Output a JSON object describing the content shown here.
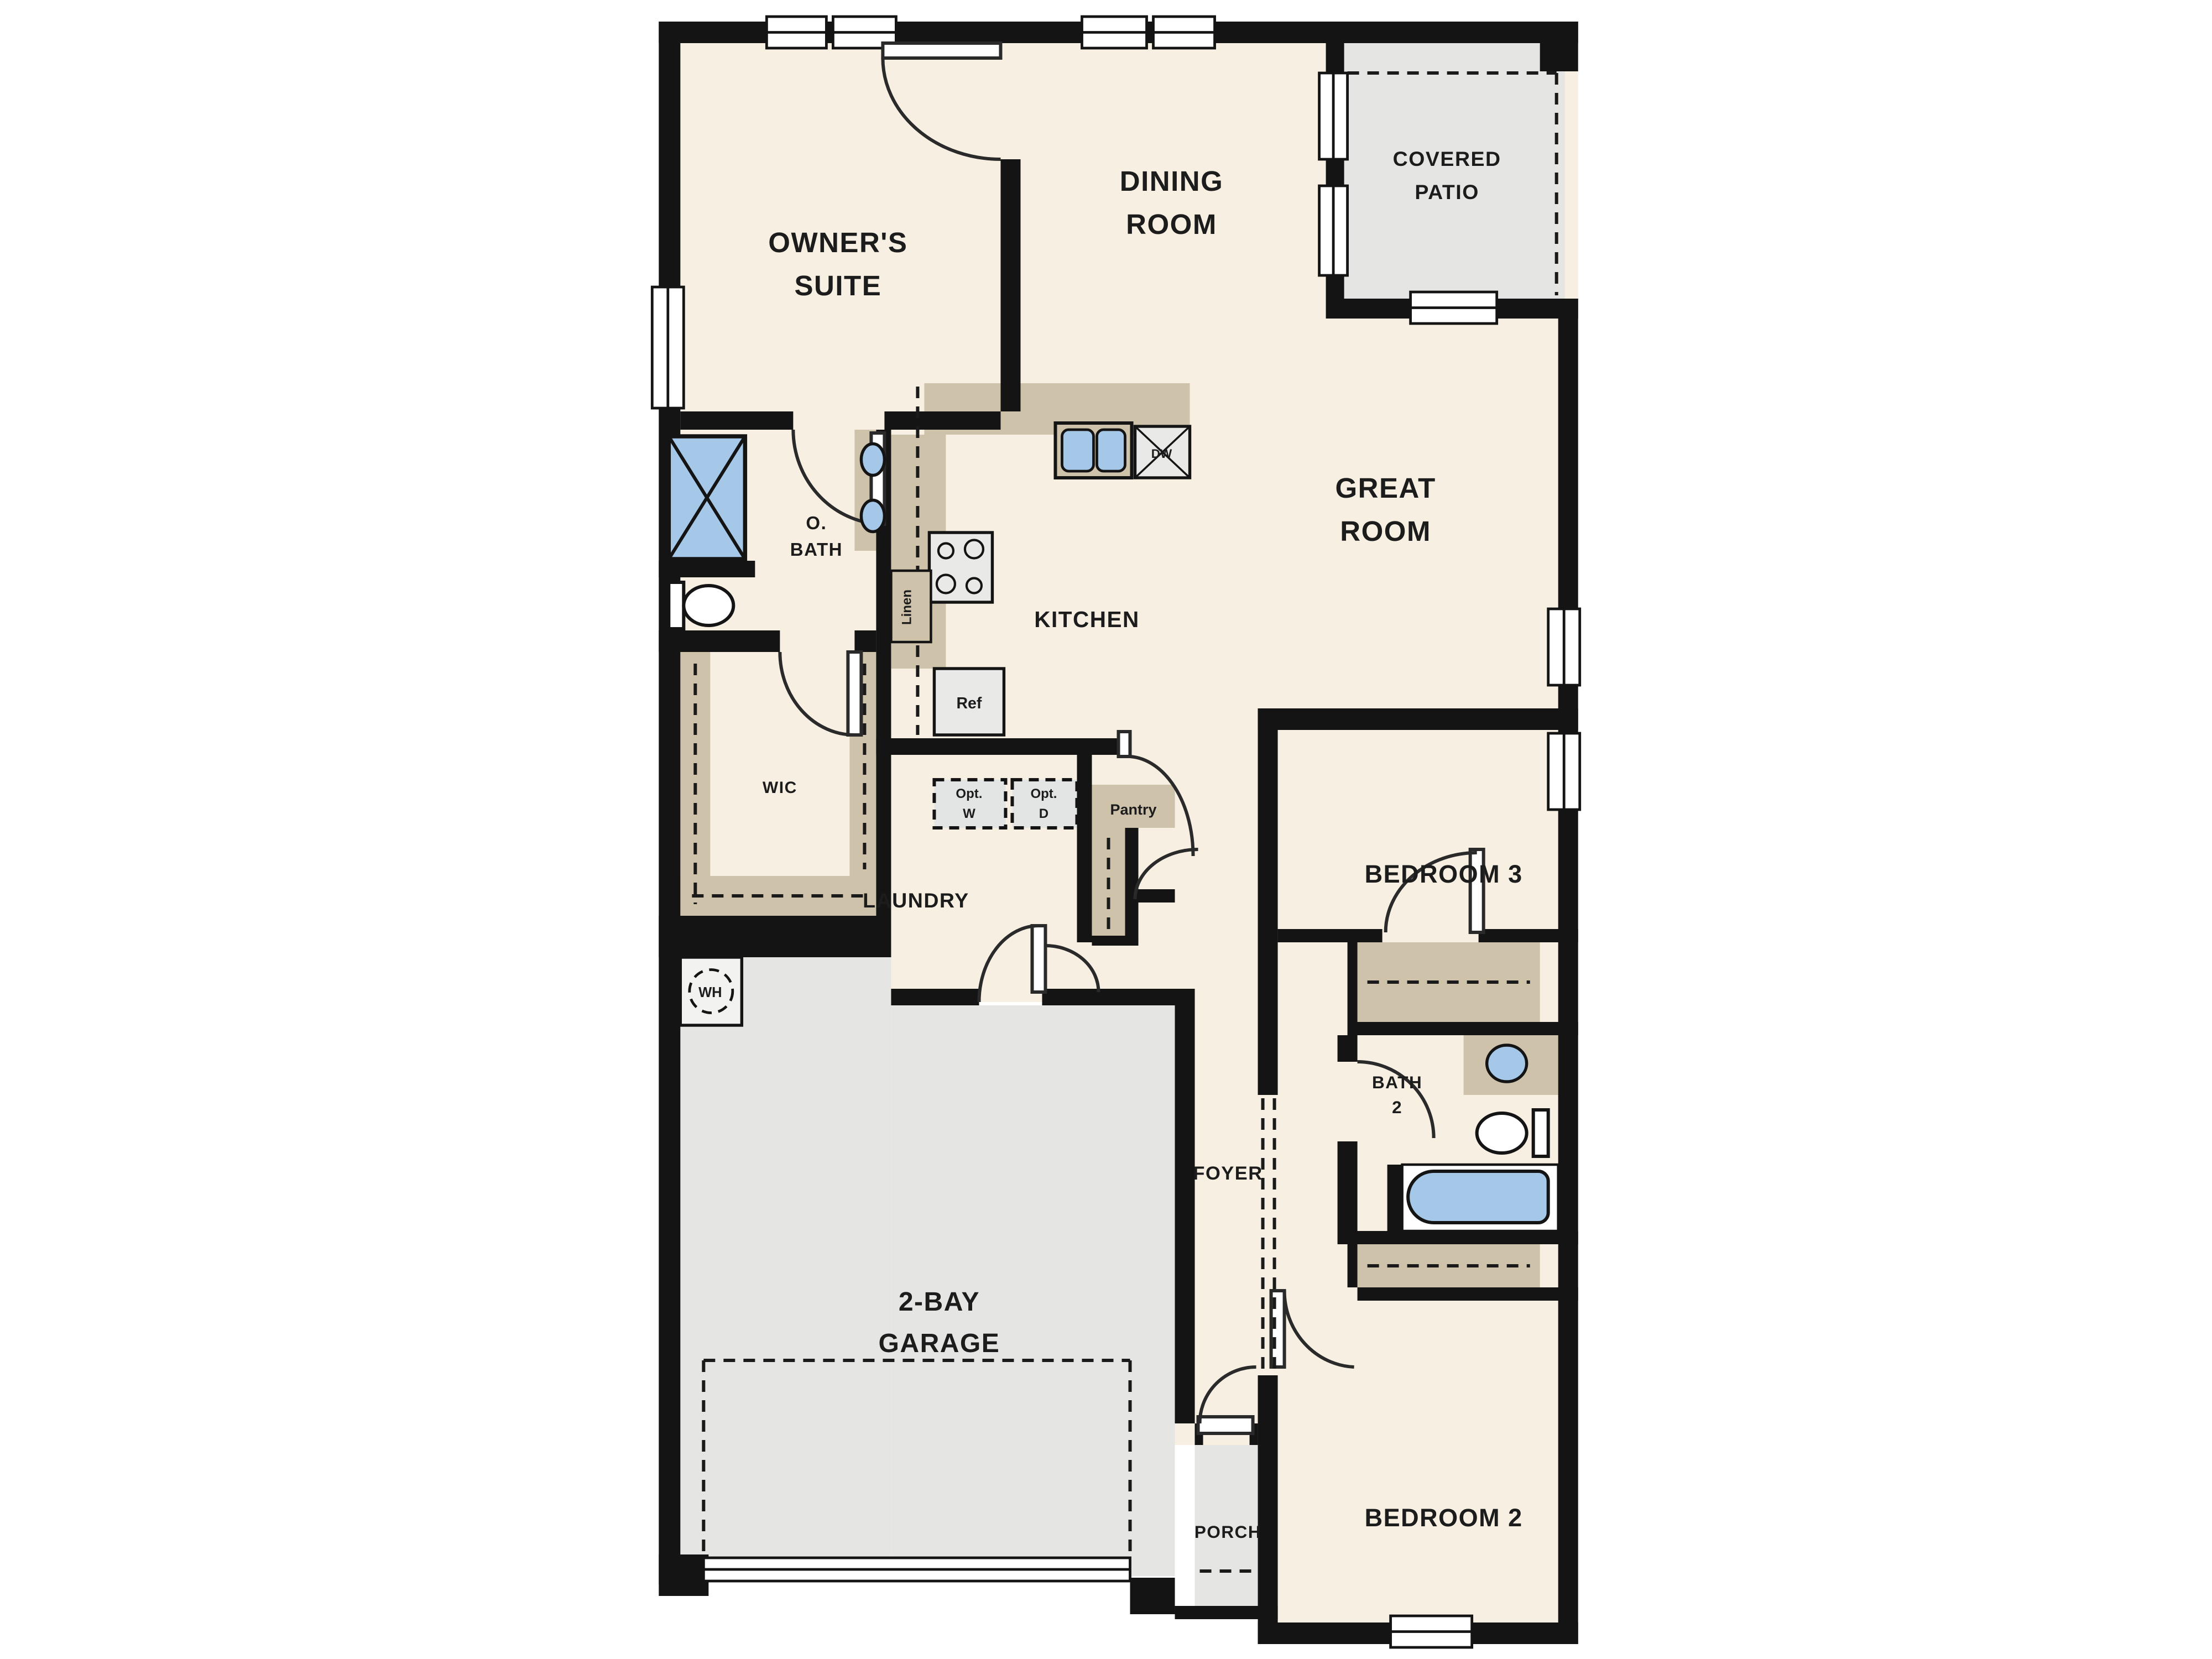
{
  "plan": {
    "rooms": {
      "owners_suite": {
        "line1": "OWNER'S",
        "line2": "SUITE"
      },
      "dining_room": {
        "line1": "DINING",
        "line2": "ROOM"
      },
      "covered_patio": {
        "line1": "COVERED",
        "line2": "PATIO"
      },
      "great_room": {
        "line1": "GREAT",
        "line2": "ROOM"
      },
      "owners_bath": {
        "line1": "O.",
        "line2": "BATH"
      },
      "kitchen": {
        "label": "KITCHEN"
      },
      "wic": {
        "label": "WIC"
      },
      "laundry": {
        "label": "LAUNDRY"
      },
      "foyer": {
        "label": "FOYER"
      },
      "bedroom3": {
        "label": "BEDROOM 3"
      },
      "bath2": {
        "line1": "BATH",
        "line2": "2"
      },
      "garage": {
        "line1": "2-BAY",
        "line2": "GARAGE"
      },
      "porch": {
        "label": "PORCH"
      },
      "bedroom2": {
        "label": "BEDROOM 2"
      }
    },
    "fixtures": {
      "linen": "Linen",
      "refrigerator": "Ref",
      "dishwasher": "DW",
      "water_heater": "WH",
      "opt_washer": {
        "line1": "Opt.",
        "line2": "W"
      },
      "opt_dryer": {
        "line1": "Opt.",
        "line2": "D"
      },
      "pantry": "Pantry"
    },
    "colors": {
      "background": "#ffffff",
      "floor": "#f6efe2",
      "exterior_floor": "#e5e5e3",
      "counter_closet_tan": "#cec2aa",
      "fixture_blue": "#a5c8e9",
      "wall": "#141414",
      "text": "#1c1c1c"
    }
  }
}
